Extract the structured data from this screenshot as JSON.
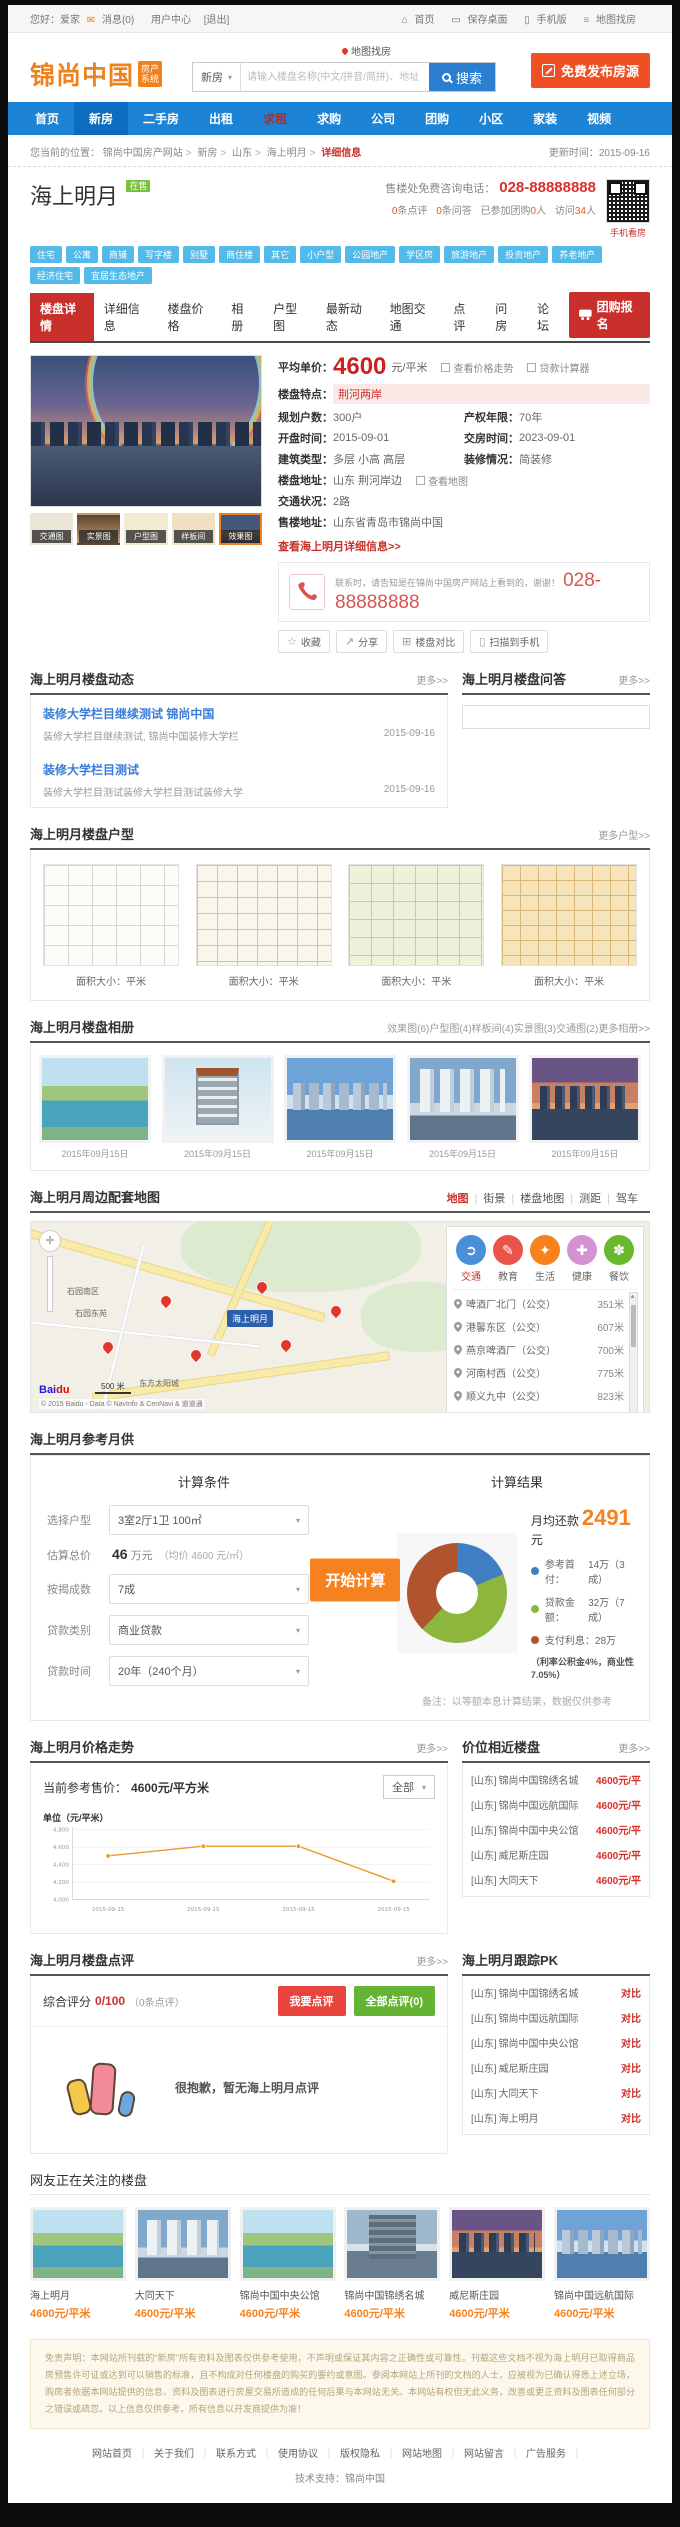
{
  "topbar": {
    "greeting": "您好：爱家",
    "message": "消息(0)",
    "user_center": "用户中心",
    "logout": "[退出]",
    "home": "首页",
    "save_desktop": "保存桌面",
    "mobile": "手机版",
    "map_search": "地图找房"
  },
  "header": {
    "logo": "锦尚中国",
    "logo_badge_1": "房产",
    "logo_badge_2": "系统",
    "map_link": "地图找房",
    "search_category": "新房",
    "search_placeholder": "请输入楼盘名称(中文/拼音/简拼)、地址",
    "search_button": "搜索",
    "publish_button": "免费发布房源"
  },
  "nav": {
    "items": [
      "首页",
      "新房",
      "二手房",
      "出租",
      "求租",
      "求购",
      "公司",
      "团购",
      "小区",
      "家装",
      "视频"
    ]
  },
  "breadcrumb": {
    "prefix": "您当前的位置：",
    "site": "锦尚中国房产网站",
    "cat": "新房",
    "region": "山东",
    "name": "海上明月",
    "current": "详细信息",
    "updated_label": "更新时间：",
    "updated": "2015-09-16"
  },
  "property": {
    "name": "海上明月",
    "status": "在售",
    "phone_label": "售楼处免费咨询电话：",
    "phone": "028-88888888",
    "qr_caption": "手机看房",
    "stats": [
      [
        "",
        "0",
        "条点评"
      ],
      [
        "",
        "0",
        "条问答"
      ],
      [
        "已参加团购",
        "0",
        "人"
      ],
      [
        "访问",
        "34",
        "人"
      ]
    ]
  },
  "tags": [
    "住宅",
    "公寓",
    "商铺",
    "写字楼",
    "别墅",
    "商住楼",
    "其它",
    "小户型",
    "公园地产",
    "学区房",
    "旅游地产",
    "投资地产",
    "养老地产",
    "经济住宅",
    "宜居生态地产"
  ],
  "tabs": {
    "items": [
      "楼盘详情",
      "详细信息",
      "楼盘价格",
      "相册",
      "户型图",
      "最新动态",
      "地图交通",
      "点评",
      "问房",
      "论坛"
    ],
    "group_button": "团购报名"
  },
  "info": {
    "price_label": "平均单价：",
    "price": "4600",
    "price_unit": "元/平米",
    "trend_link": "查看价格走势",
    "loan_link": "贷款计算器",
    "feature_label": "楼盘特点：",
    "feature": "荆河两岸",
    "households_label": "规划户数：",
    "households": "300户",
    "tenure_label": "产权年限：",
    "tenure": "70年",
    "open_label": "开盘时间：",
    "open_date": "2015-09-01",
    "delivery_label": "交房时间：",
    "delivery_date": "2023-09-01",
    "building_label": "建筑类型：",
    "building": "多层  小高  高层",
    "decor_label": "装修情况：",
    "decor": "简装修",
    "address_label": "楼盘地址：",
    "address": "山东 荆河岸边",
    "view_map": "查看地图",
    "traffic_label": "交通状况：",
    "traffic": "2路",
    "sales_label": "售楼地址：",
    "sales_address": "山东省青岛市锦尚中国",
    "detail_link": "查看海上明月详细信息>>",
    "phone_note": "联系时，请告知是在锦尚中国房产网站上看到的，谢谢！",
    "phone": "028-88888888",
    "thumbs": [
      "交通图",
      "实景图",
      "户型图",
      "样板间",
      "效果图"
    ],
    "actions": [
      "收藏",
      "分享",
      "楼盘对比",
      "扫描到手机"
    ]
  },
  "dynamics": {
    "title": "海上明月楼盘动态",
    "more": "更多>>",
    "items": [
      {
        "title": "装修大学栏目继续测试 锦尚中国",
        "desc": "装修大学栏目继续测试, 锦尚中国装修大学栏",
        "date": "2015-09-16"
      },
      {
        "title": "装修大学栏目测试",
        "desc": "装修大学栏目测试装修大学栏目测试装修大学",
        "date": "2015-09-16"
      }
    ]
  },
  "qa": {
    "title": "海上明月楼盘问答",
    "more": "更多>>"
  },
  "floorplans": {
    "title": "海上明月楼盘户型",
    "more": "更多户型>>",
    "caption": "面积大小：平米"
  },
  "album": {
    "title": "海上明月楼盘相册",
    "links": [
      "效果图(6)",
      "户型图(4)",
      "样板间(4)",
      "实景图(3)",
      "交通图(2)"
    ],
    "more": "更多相册>>",
    "date": "2015年09月15日"
  },
  "map": {
    "title": "海上明月周边配套地图",
    "links": [
      "地图",
      "街景",
      "楼盘地图",
      "测距",
      "驾车"
    ],
    "categories": [
      {
        "label": "交通",
        "color": "#4a90d9",
        "glyph": "➲"
      },
      {
        "label": "教育",
        "color": "#e8534a",
        "glyph": "✎"
      },
      {
        "label": "生活",
        "color": "#f5821f",
        "glyph": "✦"
      },
      {
        "label": "健康",
        "color": "#d293d0",
        "glyph": "✚"
      },
      {
        "label": "餐饮",
        "color": "#6ab82e",
        "glyph": "✽"
      }
    ],
    "places": [
      {
        "name": "啤酒厂北门（公交）",
        "dist": "351米"
      },
      {
        "name": "港馨东区（公交）",
        "dist": "607米"
      },
      {
        "name": "燕京啤酒厂（公交）",
        "dist": "700米"
      },
      {
        "name": "河南村西（公交）",
        "dist": "775米"
      },
      {
        "name": "顺义九中（公交）",
        "dist": "823米"
      },
      {
        "name": "减河路口（公交）",
        "dist": "852米"
      },
      {
        "name": "临河村口（公交）",
        "dist": "880米"
      }
    ],
    "labels": [
      "石园南区",
      "石园东苑",
      "东方太阳城"
    ],
    "pin_label": "海上明月",
    "scale": "500 米",
    "logo_1": "Bai",
    "logo_2": "du",
    "attribution": "© 2015 Baidu - Data © NavInfo & CenNavi & 道道通"
  },
  "calculator": {
    "title": "海上明月参考月供",
    "cond_title": "计算条件",
    "result_title": "计算结果",
    "unit_label": "选择户型",
    "unit": "3室2厅1卫 100㎡",
    "total_label": "估算总价",
    "total": "46",
    "total_unit": "万元",
    "total_note": "（均价 4600 元/㎡）",
    "ratio_label": "按揭成数",
    "ratio": "7成",
    "type_label": "贷款类别",
    "type": "商业贷款",
    "term_label": "贷款时间",
    "term": "20年（240个月）",
    "button": "开始计算",
    "monthly_label": "月均还款",
    "monthly": "2491",
    "monthly_unit": "元",
    "legend": [
      {
        "label": "参考首付：",
        "value": "14万（3成）",
        "color": "#3f7ec2"
      },
      {
        "label": "贷款金额：",
        "value": "32万（7成）",
        "color": "#8cb63c"
      },
      {
        "label": "支付利息：",
        "value": "28万",
        "color": "#b0532f"
      }
    ],
    "rate_note": "（利率公积金4%，商业性7.05%）",
    "note": "备注：以等额本息计算结果，数据仅供参考"
  },
  "trend": {
    "title": "海上明月价格走势",
    "more": "更多>>",
    "current_label": "当前参考售价：",
    "current": "4600元/平方米",
    "filter": "全部",
    "ylabel": "单位（元/平米）"
  },
  "chart_data": [
    {
      "type": "line",
      "title": "海上明月价格走势",
      "ylabel": "单位（元/平米）",
      "x": [
        "2015-09-15",
        "2015-09-15",
        "2015-09-15",
        "2015-09-15"
      ],
      "values": [
        4500,
        4610,
        4610,
        4210
      ],
      "ylim": [
        4000,
        4800
      ],
      "yticks": [
        4000,
        4200,
        4400,
        4600,
        4800
      ],
      "line_color": "#e79a2e",
      "grid": true,
      "legend_position": "none"
    },
    {
      "type": "pie",
      "donut": true,
      "title": "月供构成",
      "labels": [
        "参考首付",
        "贷款金额",
        "支付利息"
      ],
      "values": [
        14,
        32,
        28
      ],
      "unit": "万",
      "colors": [
        "#3f7ec2",
        "#8cb63c",
        "#b0532f"
      ]
    }
  ],
  "nearby": {
    "title": "价位相近楼盘",
    "more": "更多>>",
    "items": [
      {
        "region": "[山东]",
        "name": "锦尚中国锦绣名城",
        "price": "4600元/平"
      },
      {
        "region": "[山东]",
        "name": "锦尚中国远航国际",
        "price": "4600元/平"
      },
      {
        "region": "[山东]",
        "name": "锦尚中国中央公馆",
        "price": "4600元/平"
      },
      {
        "region": "[山东]",
        "name": "威尼斯庄园",
        "price": "4600元/平"
      },
      {
        "region": "[山东]",
        "name": "大同天下",
        "price": "4600元/平"
      }
    ]
  },
  "reviews": {
    "title": "海上明月楼盘点评",
    "more": "更多>>",
    "score_label": "综合评分",
    "score": "0/100",
    "count": "（0条点评）",
    "btn_review": "我要点评",
    "btn_all": "全部点评(0)",
    "empty": "很抱歉，暂无海上明月点评"
  },
  "pk": {
    "title": "海上明月跟踪PK",
    "action": "对比",
    "items": [
      {
        "region": "[山东]",
        "name": "锦尚中国锦绣名城"
      },
      {
        "region": "[山东]",
        "name": "锦尚中国远航国际"
      },
      {
        "region": "[山东]",
        "name": "锦尚中国中央公馆"
      },
      {
        "region": "[山东]",
        "name": "威尼斯庄园"
      },
      {
        "region": "[山东]",
        "name": "大同天下"
      },
      {
        "region": "[山东]",
        "name": "海上明月"
      }
    ]
  },
  "watching": {
    "title": "网友正在关注的楼盘",
    "cards": [
      {
        "name": "海上明月",
        "price": "4600元/平米"
      },
      {
        "name": "大同天下",
        "price": "4600元/平米"
      },
      {
        "name": "锦尚中国中央公馆",
        "price": "4600元/平米"
      },
      {
        "name": "锦尚中国锦绣名城",
        "price": "4600元/平米"
      },
      {
        "name": "威尼斯庄园",
        "price": "4600元/平米"
      },
      {
        "name": "锦尚中国远航国际",
        "price": "4600元/平米"
      }
    ]
  },
  "disclaimer": "免责声明：本网站所刊载的“新房”所有资料及图表仅供参考使用，不声明或保证其内容之正确性或可靠性。刊载这些文档不视为海上明月已取得商品房预售许可证或达到可以销售的标准，且不构成对任何楼盘的购买的要约或意图。参阅本网站上所刊的文档的人士，应被视为已确认得悉上述立场，购房者依据本网站提供的信息、资料及图表进行房屋交易所造成的任何后果与本网站无关。本网站有权但无此义务，改善或更正资料及图表任何部分之错误或疏忽。以上信息仅供参考，所有信息以开发商提供为准！",
  "footer": {
    "links": [
      "网站首页",
      "关于我们",
      "联系方式",
      "使用协议",
      "版权隐私",
      "网站地图",
      "网站留言",
      "广告服务"
    ],
    "support_label": "技术支持：",
    "support": "锦尚中国"
  }
}
